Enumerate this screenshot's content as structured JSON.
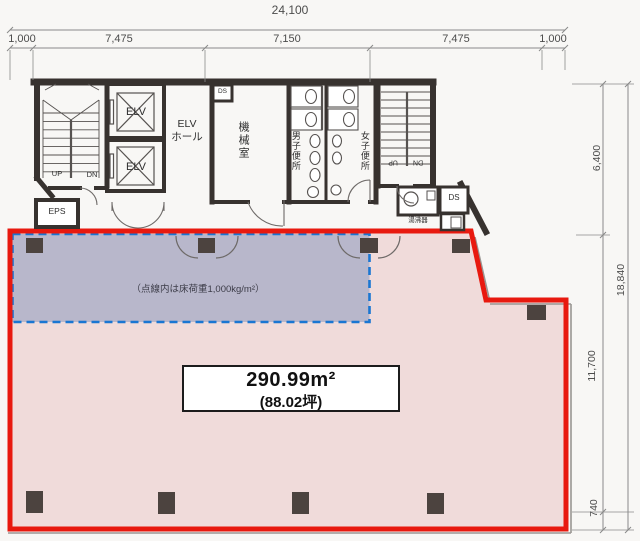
{
  "drawing": {
    "dims_top": {
      "total": "24,100",
      "segments": [
        "1,000",
        "7,475",
        "7,150",
        "7,475",
        "1,000"
      ]
    },
    "dims_right": {
      "total": "18,840",
      "seg_upper": "6,400",
      "seg_mid": "11,700",
      "seg_bottom": "740"
    },
    "core": {
      "elv1": "ELV",
      "elv2": "ELV",
      "elv_hall_l1": "ELV",
      "elv_hall_l2": "ホール",
      "machine_room": "機械室",
      "ds_small": "DS",
      "mens_toilet": "男子便所",
      "womens_toilet": "女子便所",
      "eps": "EPS",
      "stair_left_up": "UP",
      "stair_left_dn": "DN",
      "stair_right_up": "UP",
      "stair_right_dn": "DN",
      "water_heater": "湯沸器",
      "ds_right": "DS"
    },
    "tenant": {
      "area_m2": "290.99m²",
      "area_tsubo": "(88.02坪)",
      "load_note": "（点線内は床荷重1,000kg/m²）"
    },
    "colors": {
      "boundary_red": "#e8190f",
      "floor_pink": "#f0dbda",
      "overlay_blue_fill": "rgba(150,162,194,0.62)",
      "overlay_blue_border": "#1a76d2",
      "wall_dark": "#37322f",
      "column_dark": "#4c433f",
      "dim_gray": "#555555"
    }
  }
}
